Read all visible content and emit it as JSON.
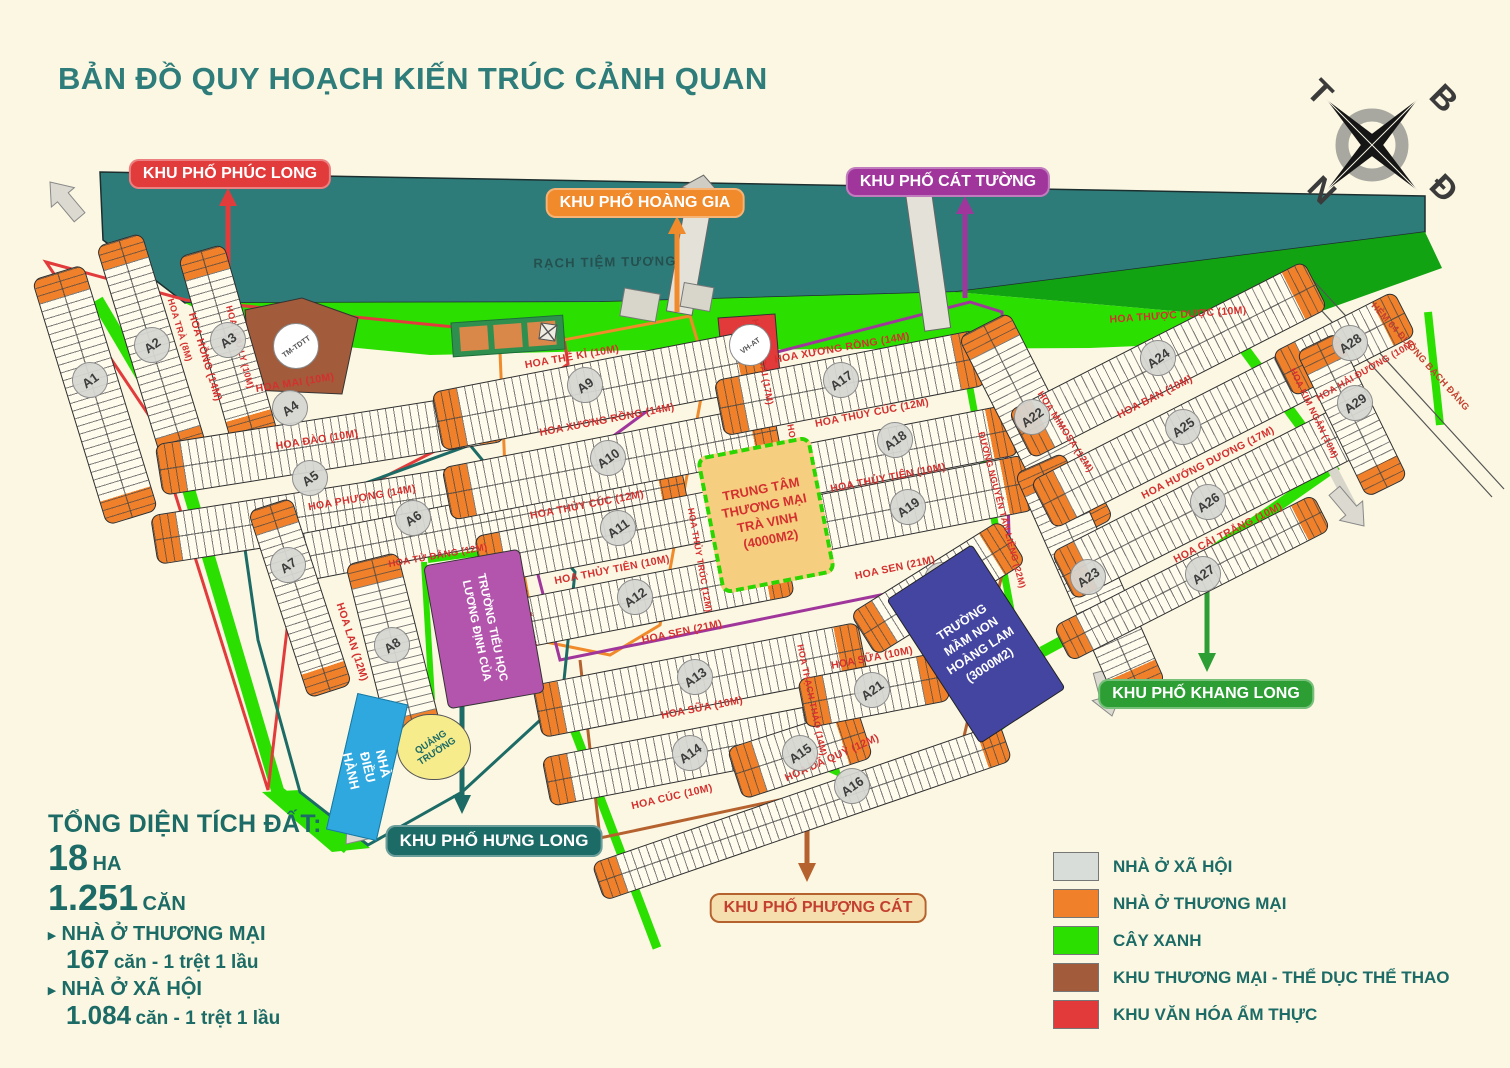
{
  "title": "BẢN ĐỒ QUY HOẠCH KIẾN TRÚC CẢNH QUAN",
  "compass": {
    "north": "B",
    "east": "Đ",
    "south": "N",
    "west": "T"
  },
  "river": {
    "label": "RẠCH TIỆM TƯƠNG"
  },
  "zones": [
    {
      "id": "phuc-long",
      "label": "KHU PHỐ PHÚC LONG",
      "color": "#E23B3C",
      "bg": "#E23B3C",
      "text": "#FFFFFF"
    },
    {
      "id": "hoang-gia",
      "label": "KHU PHỐ HOÀNG GIA",
      "color": "#F08A2B",
      "bg": "#F08A2B",
      "text": "#FFFFFF"
    },
    {
      "id": "cat-tuong",
      "label": "KHU PHỐ CÁT TƯỜNG",
      "color": "#A0369C",
      "bg": "#A0369C",
      "text": "#FFFFFF"
    },
    {
      "id": "khang-long",
      "label": "KHU PHỐ KHANG LONG",
      "color": "#2D9E34",
      "bg": "#2D9E34",
      "text": "#FFFFFF"
    },
    {
      "id": "hung-long",
      "label": "KHU PHỐ HƯNG LONG",
      "color": "#1C6B66",
      "bg": "#1C6B66",
      "text": "#FFFFFF"
    },
    {
      "id": "phuong-cat",
      "label": "KHU PHỐ PHƯỢNG CÁT",
      "color": "#B5622F",
      "bg": "#F6DFAF",
      "text": "#C3402F"
    }
  ],
  "streets": [
    "HOA HỒNG (14M)",
    "HOA TRÀ (8M)",
    "HOA LƯU LY (10M)",
    "HOA MAI (10M)",
    "HOA ĐÀO (10M)",
    "HOA PHƯỢNG (14M)",
    "HOA TỬ ĐẰNG (12M)",
    "HOA LAN (12M)",
    "HOA DIÊN VĨ (16M)",
    "HOA THẾ KỈ (10M)",
    "HOA LỆ GAI (17M)",
    "HOA XƯƠNG RỒNG (14M)",
    "HOA XƯƠNG RỒNG (14M)",
    "HOA THỦY CÚC (12M)",
    "HOA THỦY CÚC (12M)",
    "HOA THỦY TIÊN (10M)",
    "HOA THỦY TIÊN (10M)",
    "HOA THỦY QUỲNH (12M)",
    "HOA THỦY TRÚC (12M)",
    "HOA SEN (21M)",
    "HOA SEN (21M)",
    "HOA SỮA (10M)",
    "HOA SỮA (10M)",
    "HOA THẠCH THẢO (14M)",
    "HOA CÚC (10M)",
    "HOA DÃ QUỲ (12M)",
    "ĐƯỜNG NGUYỄN TẤN LIỀNG (22M)",
    "HOA MIMOSA (12M)",
    "HOA THƯỢC DƯỢC (10M)",
    "HOA BAN (10M)",
    "HOA HƯỚNG DƯƠNG (17M)",
    "HOA CẢI TRẮNG (10M)",
    "HOA HẢI ĐƯỜNG (10M)",
    "HOA KIM NGÂN (10M)",
    "HẺM 64 ĐƯỜNG BẠCH ĐẰNG"
  ],
  "blocks": [
    "A1",
    "A2",
    "A3",
    "A4",
    "A5",
    "A6",
    "A7",
    "A8",
    "A9",
    "A10",
    "A11",
    "A12",
    "A13",
    "A14",
    "A15",
    "A16",
    "A17",
    "A18",
    "A19",
    "A20",
    "A21",
    "A22",
    "A23",
    "A24",
    "A25",
    "A26",
    "A27",
    "A28",
    "A29"
  ],
  "facilities": {
    "trade_center": [
      "TRUNG TÂM",
      "THƯƠNG MẠI",
      "TRÀ VINH",
      "(4000M2)"
    ],
    "kindergarten": [
      "TRƯỜNG",
      "MẦM NON",
      "HOÀNG LAM",
      "(3000M2)"
    ],
    "primary_school": [
      "TRƯỜNG TIỂU HỌC",
      "LƯƠNG ĐỊNH CỦA"
    ],
    "square": "QUẢNG TRƯỜNG",
    "admin": "NHÀ ĐIỀU HÀNH",
    "tm_tdtt": "TM-TDTT",
    "vh_at": "VH-AT"
  },
  "stats": {
    "heading": "TỔNG DIỆN TÍCH ĐẤT:",
    "area_value": "18",
    "area_unit": "HA",
    "total_value": "1.251",
    "total_unit": "CĂN",
    "items": [
      {
        "label": "NHÀ Ở THƯƠNG MẠI",
        "value": "167",
        "detail": "căn - 1 trệt 1 lầu"
      },
      {
        "label": "NHÀ Ở XÃ HỘI",
        "value": "1.084",
        "detail": "căn - 1 trệt 1 lầu"
      }
    ]
  },
  "legend": [
    {
      "label": "NHÀ Ở XÃ HỘI",
      "color": "#D8DDD9"
    },
    {
      "label": "NHÀ Ở THƯƠNG MẠI",
      "color": "#F0812A"
    },
    {
      "label": "CÂY XANH",
      "color": "#2BE000"
    },
    {
      "label": "KHU THƯƠNG MẠI - THỂ DỤC THỂ THAO",
      "color": "#A25B3B"
    },
    {
      "label": "KHU VĂN HÓA ẨM THỰC",
      "color": "#E23A3A"
    }
  ],
  "colors": {
    "background": "#FBF7E2",
    "title": "#2E7D7B",
    "river": "#2E7C7A",
    "green_bright": "#2BE000",
    "green_dark": "#12A312",
    "street_label": "#D4302F",
    "stats_text": "#1C6B66"
  }
}
